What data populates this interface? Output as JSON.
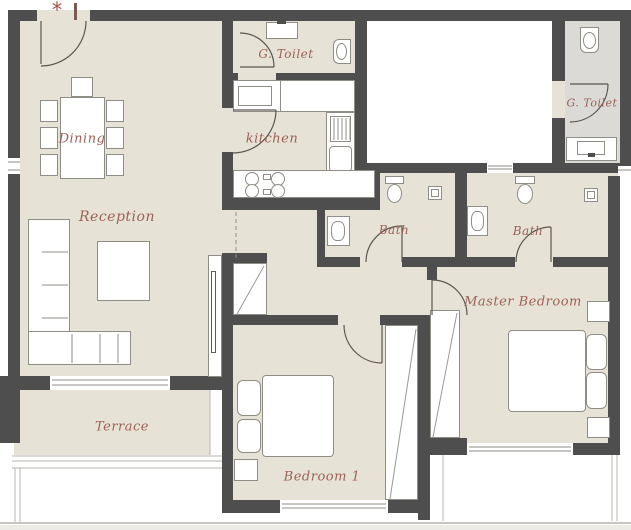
{
  "rooms": [
    {
      "id": "dining",
      "label": "Dining"
    },
    {
      "id": "reception",
      "label": "Reception"
    },
    {
      "id": "kitchen",
      "label": "kitchen"
    },
    {
      "id": "g-toilet-1",
      "label": "G. Toilet"
    },
    {
      "id": "g-toilet-2",
      "label": "G. Toilet"
    },
    {
      "id": "bath-1",
      "label": "Bath"
    },
    {
      "id": "bath-2",
      "label": "Bath"
    },
    {
      "id": "master-bedroom",
      "label": "Master Bedroom"
    },
    {
      "id": "bedroom-1",
      "label": "Bedroom 1"
    },
    {
      "id": "terrace",
      "label": "Terrace"
    }
  ],
  "entry": {
    "asterisk": "*"
  },
  "colors": {
    "wall": "#4e4e4e",
    "floor": "#e7e2d6",
    "toilet_floor": "#dbdad7",
    "label": "#9d6158"
  }
}
